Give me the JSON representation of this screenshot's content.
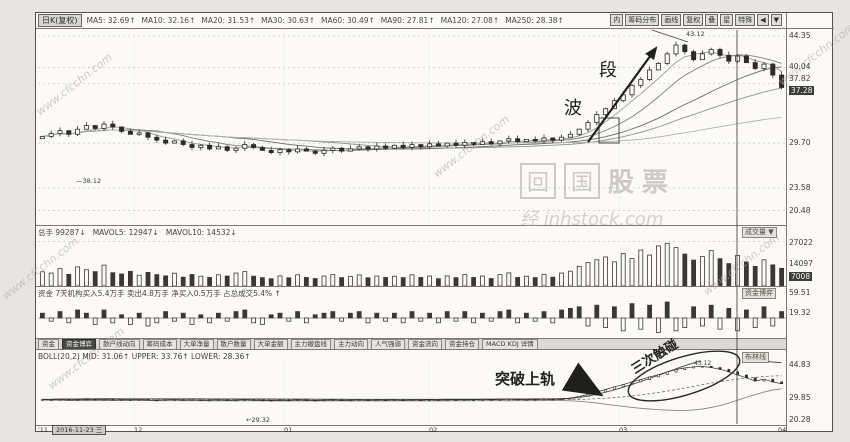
{
  "header": {
    "period": "日K(复权)",
    "ma_items": [
      "MA5: 32.69↑",
      "MA10: 32.16↑",
      "MA20: 31.53↑",
      "MA30: 30.63↑",
      "MA60: 30.49↑",
      "MA90: 27.81↑",
      "MA120: 27.08↑",
      "MA250: 28.38↑"
    ],
    "toolbar": [
      "内",
      "筹码分布",
      "画线",
      "复权",
      "叠",
      "星",
      "特殊",
      "◀",
      "▼"
    ]
  },
  "volume_panel": {
    "title_items": [
      "总手 99287↓",
      "MAVOL5: 12947↓",
      "MAVOL10: 14532↓"
    ],
    "panel_label": "成交量 ▼"
  },
  "fund_panel": {
    "title": "资金 7天机构买入5.4万手 卖出4.8万手 净买入0.5万手 占总成交5.4% ↑",
    "panel_label": "资金博弈",
    "axis": [
      "59.51",
      "19.32"
    ]
  },
  "tabs": {
    "items": [
      "资金",
      "资金博弈",
      "散户线动向",
      "筹码成本",
      "大单净量",
      "散户数量",
      "大单金额",
      "主力撤盘线",
      "主力动向",
      "人气强弱",
      "资金流向",
      "资金持仓",
      "MACD KDJ 详情"
    ],
    "active": "资金博弈"
  },
  "boll_panel": {
    "title": "BOLL(20,2)  MID: 31.06↑  UPPER: 33.76↑  LOWER: 28.36↑",
    "panel_label": "布林线"
  },
  "date_axis": {
    "year": "'11",
    "date_box": "2016-11-23 三",
    "ticks": [
      "12",
      "01",
      "02",
      "03",
      "04"
    ]
  },
  "annotations": {
    "wave_big": "段",
    "wave_small": "波",
    "peak_price": "43.12",
    "breakout": "突破上轨",
    "touch": "三次触碰",
    "boll_peak": "43.12",
    "main_level": "—38.12",
    "boll_level": "←29.32"
  },
  "watermark": {
    "site": "www.cfcchn.com",
    "brand_char1": "回",
    "brand_char2": "国",
    "brand_text": "股票",
    "brand_line2": "经  inhstock.com"
  },
  "chart_data": {
    "type": "candlestick",
    "title": "日K线 BOLL三次触碰上轨示意图",
    "x_months": [
      "11",
      "12",
      "01",
      "02",
      "03",
      "04"
    ],
    "main_ylim": [
      18.5,
      45.3
    ],
    "main_axis_values": [
      44.35,
      40.04,
      37.82,
      29.7,
      23.58,
      20.48
    ],
    "price_box": 37.28,
    "closes": [
      30.6,
      31.0,
      31.4,
      30.9,
      31.6,
      32.1,
      31.7,
      32.3,
      31.9,
      31.3,
      30.9,
      31.1,
      30.5,
      30.1,
      29.7,
      30.0,
      29.5,
      29.1,
      29.4,
      28.9,
      29.2,
      28.7,
      29.0,
      29.5,
      29.1,
      28.7,
      28.4,
      28.8,
      28.5,
      28.9,
      28.6,
      28.3,
      28.7,
      29.0,
      28.6,
      28.9,
      29.2,
      28.9,
      29.3,
      29.0,
      29.4,
      29.1,
      29.5,
      29.2,
      29.6,
      29.3,
      29.7,
      29.4,
      29.8,
      29.5,
      29.9,
      29.6,
      30.0,
      30.3,
      29.9,
      30.2,
      30.0,
      30.4,
      30.1,
      30.5,
      30.9,
      31.6,
      32.5,
      33.6,
      34.4,
      35.5,
      36.3,
      37.6,
      38.4,
      39.7,
      40.6,
      41.9,
      43.1,
      42.2,
      41.1,
      41.9,
      42.5,
      41.7,
      40.9,
      41.6,
      40.7,
      39.9,
      40.5,
      39.0,
      37.3
    ],
    "ma_periods": [
      5,
      10,
      20,
      30,
      60
    ],
    "volume_max": 28500,
    "volume_axis_values": [
      27022,
      14097
    ],
    "volume_box": 7008,
    "volumes": [
      9000,
      8200,
      11000,
      7400,
      12100,
      10300,
      9100,
      13200,
      8400,
      7600,
      9300,
      6800,
      8600,
      7200,
      6400,
      8100,
      5600,
      7300,
      6200,
      5400,
      7100,
      6300,
      8200,
      9100,
      6200,
      5300,
      4600,
      6400,
      5200,
      7100,
      5400,
      4700,
      6300,
      7200,
      5300,
      6100,
      7000,
      5200,
      6300,
      5400,
      6200,
      5300,
      7100,
      5400,
      6300,
      4600,
      6400,
      5300,
      7200,
      5400,
      6300,
      4700,
      7200,
      8300,
      5400,
      6200,
      5300,
      7400,
      5600,
      8200,
      9400,
      12500,
      14800,
      16600,
      18400,
      15300,
      20600,
      17400,
      22800,
      19600,
      25400,
      27022,
      24300,
      20200,
      16400,
      18600,
      22400,
      17300,
      14200,
      19400,
      15300,
      12400,
      16600,
      13400,
      11200
    ],
    "moneyflow": [
      0.3,
      -0.2,
      0.4,
      -0.3,
      0.5,
      0.3,
      -0.4,
      0.5,
      -0.3,
      0.2,
      -0.4,
      0.3,
      -0.5,
      -0.3,
      0.4,
      -0.2,
      0.3,
      -0.4,
      0.2,
      -0.3,
      0.3,
      -0.2,
      0.4,
      0.5,
      -0.3,
      -0.4,
      0.2,
      0.3,
      -0.2,
      0.4,
      -0.3,
      0.2,
      0.3,
      0.4,
      -0.2,
      0.3,
      0.4,
      -0.3,
      0.3,
      -0.2,
      0.3,
      -0.3,
      0.4,
      -0.2,
      0.3,
      -0.3,
      0.4,
      -0.2,
      0.4,
      -0.3,
      0.3,
      -0.2,
      0.4,
      0.5,
      -0.3,
      0.3,
      -0.2,
      0.4,
      -0.3,
      0.5,
      0.6,
      0.7,
      -0.5,
      0.8,
      -0.6,
      0.7,
      -0.8,
      0.9,
      -0.7,
      0.8,
      -0.9,
      1.0,
      -0.8,
      -0.6,
      0.7,
      -0.5,
      0.8,
      -0.7,
      0.6,
      -0.8,
      0.5,
      -0.6,
      0.7,
      -0.5,
      0.4
    ],
    "boll_ylim": [
      18,
      46.5
    ],
    "boll_axis_values": [
      44.83,
      29.85,
      20.28
    ],
    "boll_price": [
      29.3,
      29.2,
      29.4,
      29.1,
      29.3,
      29.5,
      29.2,
      29.4,
      29.1,
      29.3,
      29.2,
      29.4,
      29.1,
      29.0,
      29.2,
      29.3,
      29.1,
      29.2,
      29.0,
      29.1,
      29.2,
      29.0,
      29.1,
      29.3,
      29.1,
      29.0,
      28.9,
      29.1,
      29.0,
      29.2,
      29.0,
      28.9,
      29.1,
      29.2,
      29.0,
      29.1,
      29.2,
      29.0,
      29.2,
      29.1,
      29.2,
      29.0,
      29.2,
      29.1,
      29.3,
      29.1,
      29.3,
      29.2,
      29.3,
      29.2,
      29.4,
      29.2,
      29.4,
      29.5,
      29.3,
      29.4,
      29.3,
      29.5,
      29.4,
      29.6,
      30.0,
      30.7,
      31.6,
      32.7,
      33.8,
      35.0,
      36.0,
      37.2,
      38.2,
      39.4,
      40.4,
      41.6,
      42.7,
      43.4,
      43.9,
      44.1,
      43.6,
      42.8,
      41.7,
      40.3,
      39.0,
      37.6,
      38.4,
      37.2,
      36.4
    ],
    "month_x": [
      96,
      246,
      391,
      581,
      753
    ]
  }
}
